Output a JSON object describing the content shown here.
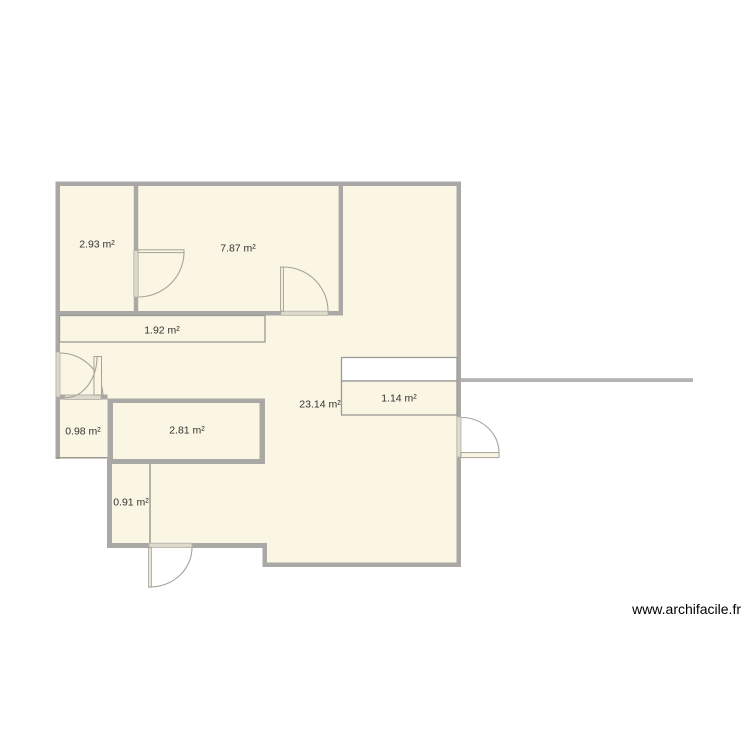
{
  "watermark": {
    "text": "www.archifacile.fr"
  },
  "colors": {
    "background": "#ffffff",
    "room_fill": "#faf6e3",
    "wall": "#a9a8a4",
    "wall_light": "#b3b3b3",
    "thin_border": "#9a9a96",
    "door_opening": "#ddd9cb",
    "door_opening_border": "#b5b2a8",
    "door_stroke": "#a5a299",
    "fixture_fill": "#ffffff",
    "label_text": "#333333"
  },
  "floor_plan": {
    "unit_suffix": "m²",
    "rooms": [
      {
        "name": "room-top-left",
        "area_label": "2.93 m²"
      },
      {
        "name": "room-top-center",
        "area_label": "7.87 m²"
      },
      {
        "name": "corridor",
        "area_label": "1.92 m²"
      },
      {
        "name": "main-room",
        "area_label": "23.14 m²"
      },
      {
        "name": "room-right-small",
        "area_label": "1.14 m²"
      },
      {
        "name": "room-left-small",
        "area_label": "0.98 m²"
      },
      {
        "name": "room-center-small",
        "area_label": "2.81 m²"
      },
      {
        "name": "room-bottom-small",
        "area_label": "0.91 m²"
      }
    ]
  }
}
